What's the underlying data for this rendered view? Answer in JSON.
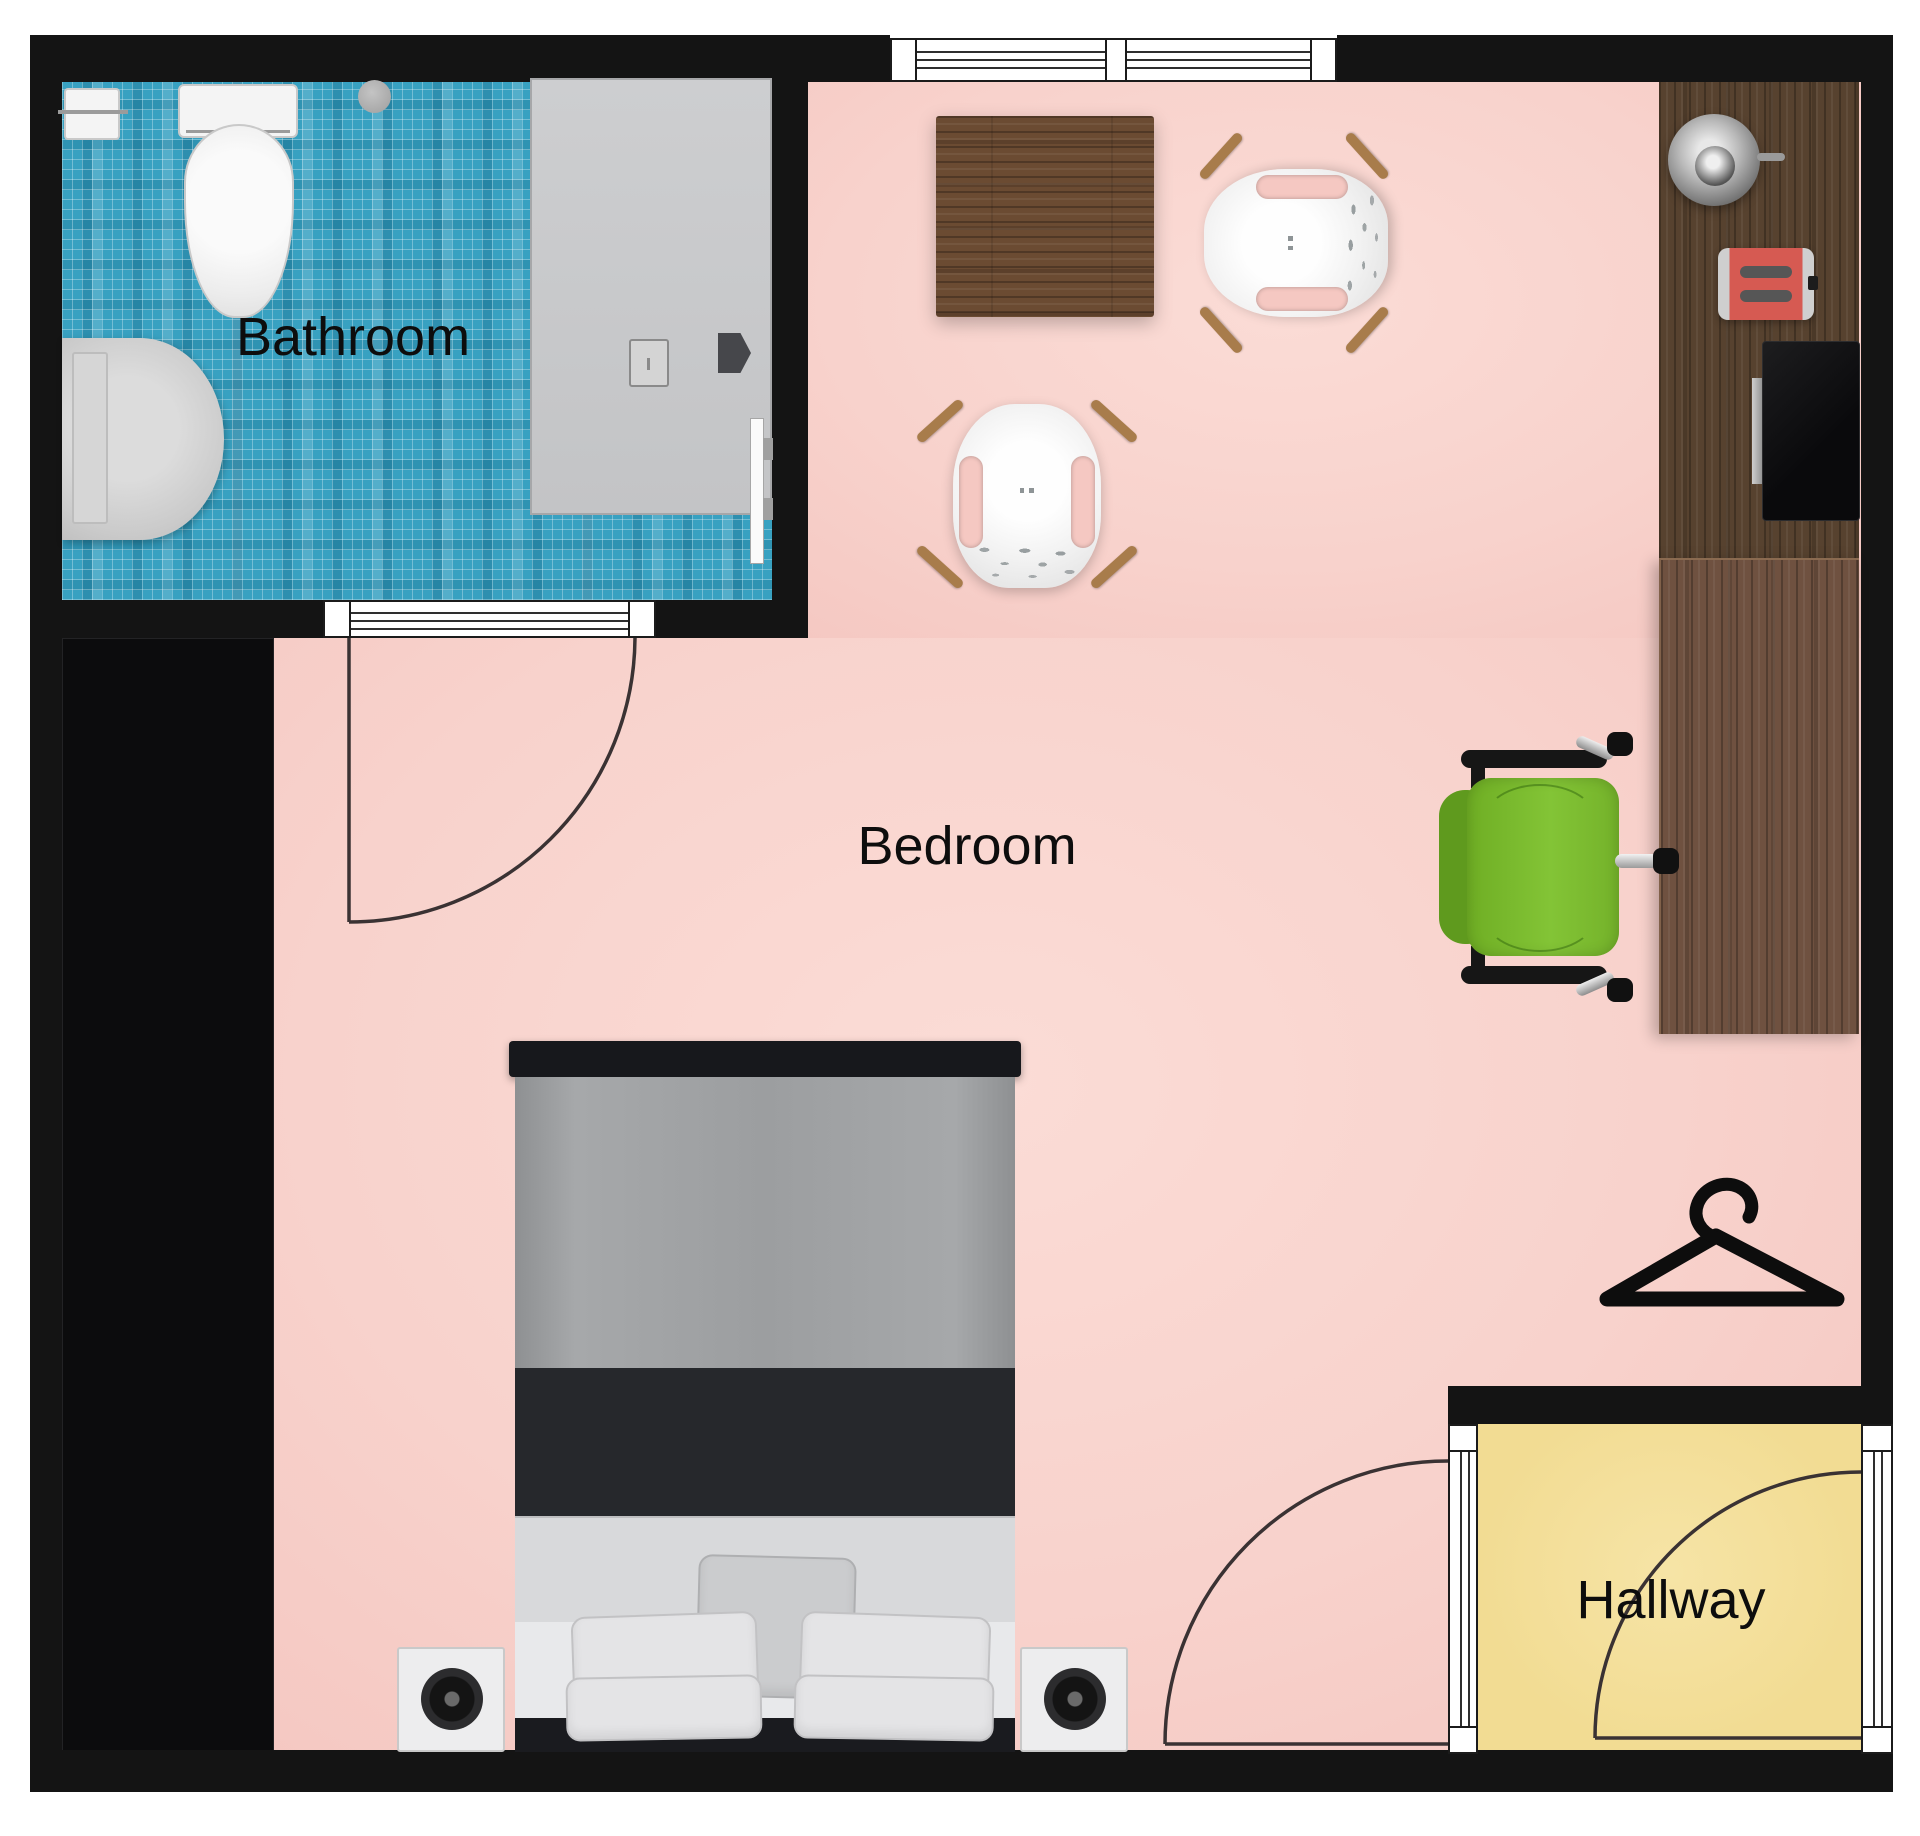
{
  "rooms": [
    {
      "name": "bathroom",
      "label": "Bathroom",
      "floor_color": "#38a1c1"
    },
    {
      "name": "bedroom",
      "label": "Bedroom",
      "floor_color": "#f8d2cc"
    },
    {
      "name": "hallway",
      "label": "Hallway",
      "floor_color": "#f2dc93"
    }
  ],
  "palette": {
    "wall_black": "#141414",
    "bathroom_tile_blue": "#38a1c1",
    "bedroom_floor_pink": "#f8d2cc",
    "hallway_floor_yellow": "#f2dc93",
    "table_wood": "#6b4b32",
    "counter_wood": "#57422f",
    "desk_wood": "#6f5140",
    "office_chair_green": "#74b42c",
    "toaster_red": "#d65a52",
    "shower_gray": "#c9cacb"
  },
  "furniture_icons": {
    "bathroom": [
      "toilet-icon",
      "toilet-paper-holder-icon",
      "ceiling-light-icon",
      "sink-icon",
      "shower-icon",
      "shower-head-icon"
    ],
    "bedroom": [
      "dining-table-icon",
      "tub-chair-icon",
      "tub-chair-icon",
      "kitchen-counter-icon",
      "lamp-icon",
      "toaster-icon",
      "tv-icon",
      "desk-icon",
      "office-chair-icon",
      "double-bed-icon",
      "pillow-icon",
      "nightstand-speaker-icon",
      "nightstand-speaker-icon",
      "clothes-hanger-icon"
    ],
    "openings": [
      "window-icon",
      "bathroom-door-icon",
      "bedroom-hallway-door-icon",
      "hallway-exterior-door-icon"
    ]
  }
}
